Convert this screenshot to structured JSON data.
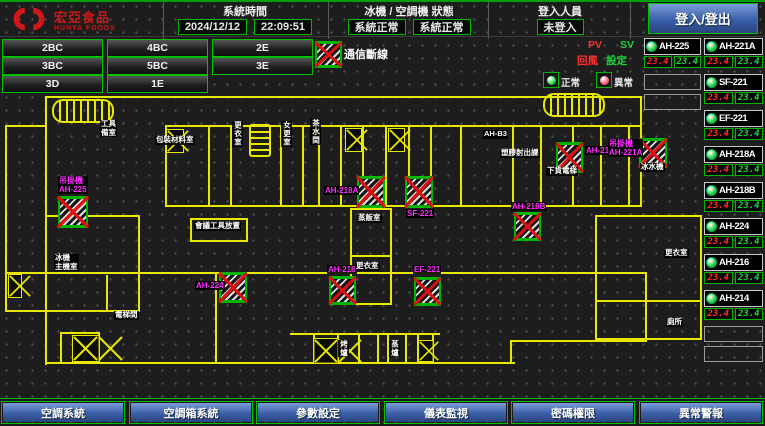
{
  "header": {
    "logo": {
      "name": "宏亞食品",
      "sub": "HUNYA FOODS"
    },
    "sections": [
      {
        "label": "系統時間",
        "values": [
          "2024/12/12",
          "22:09:51"
        ]
      },
      {
        "label": "冰機 / 空調機 狀態",
        "values": [
          "系統正常",
          "系統正常"
        ]
      },
      {
        "label": "登入人員",
        "values": [
          "未登入"
        ]
      }
    ],
    "login_button": "登入/登出"
  },
  "floor_buttons": [
    [
      "2BC",
      "4BC",
      "2E"
    ],
    [
      "3BC",
      "5BC",
      "3E"
    ],
    [
      "3D",
      "1E"
    ]
  ],
  "legend": {
    "comm_loss": "通信斷線",
    "normal": "正常",
    "abnormal": "異常",
    "pv": "PV",
    "sv": "SV",
    "pv_name": "回風",
    "sv_name": "設定"
  },
  "units": {
    "col_a": [
      {
        "name": "AH-225",
        "pv": "23.4",
        "sv": "23.4"
      }
    ],
    "col_a_empty_slots": 2,
    "col_b": [
      {
        "name": "AH-221A",
        "pv": "23.4",
        "sv": "23.4"
      },
      {
        "name": "SF-221",
        "pv": "23.4",
        "sv": "23.4"
      },
      {
        "name": "EF-221",
        "pv": "23.4",
        "sv": "23.4"
      },
      {
        "name": "AH-218A",
        "pv": "23.4",
        "sv": "23.4"
      },
      {
        "name": "AH-218B",
        "pv": "23.4",
        "sv": "23.4"
      },
      {
        "name": "AH-224",
        "pv": "23.4",
        "sv": "23.4"
      },
      {
        "name": "AH-216",
        "pv": "23.4",
        "sv": "23.4"
      },
      {
        "name": "AH-214",
        "pv": "23.4",
        "sv": "23.4"
      }
    ],
    "col_b_empty_slots": 2
  },
  "nav_buttons": [
    "空調系統",
    "空調箱系統",
    "參數設定",
    "儀表監視",
    "密碼權限",
    "異常警報"
  ],
  "map": {
    "walls": [
      [
        45,
        96,
        597,
        2
      ],
      [
        45,
        96,
        2,
        31
      ],
      [
        5,
        125,
        42,
        2
      ],
      [
        5,
        125,
        2,
        187
      ],
      [
        5,
        310,
        42,
        2
      ],
      [
        45,
        125,
        2,
        240
      ],
      [
        165,
        125,
        477,
        2
      ],
      [
        165,
        205,
        477,
        2
      ],
      [
        640,
        96,
        2,
        111
      ],
      [
        165,
        125,
        2,
        82
      ],
      [
        208,
        125,
        2,
        82
      ],
      [
        230,
        125,
        2,
        82
      ],
      [
        280,
        125,
        2,
        82
      ],
      [
        302,
        125,
        2,
        82
      ],
      [
        318,
        125,
        2,
        82
      ],
      [
        340,
        125,
        2,
        82
      ],
      [
        362,
        125,
        2,
        82
      ],
      [
        385,
        125,
        2,
        82
      ],
      [
        408,
        125,
        2,
        82
      ],
      [
        430,
        125,
        2,
        82
      ],
      [
        460,
        125,
        2,
        82
      ],
      [
        512,
        125,
        2,
        82
      ],
      [
        540,
        125,
        2,
        82
      ],
      [
        572,
        125,
        2,
        82
      ],
      [
        600,
        125,
        2,
        82
      ],
      [
        628,
        125,
        2,
        82
      ],
      [
        5,
        272,
        640,
        2
      ],
      [
        45,
        215,
        95,
        2
      ],
      [
        138,
        215,
        2,
        97
      ],
      [
        45,
        310,
        95,
        2
      ],
      [
        106,
        275,
        2,
        37
      ],
      [
        45,
        362,
        177,
        2
      ],
      [
        60,
        332,
        2,
        31
      ],
      [
        98,
        332,
        2,
        31
      ],
      [
        60,
        332,
        40,
        2
      ],
      [
        290,
        333,
        150,
        2
      ],
      [
        215,
        362,
        300,
        2
      ],
      [
        313,
        333,
        2,
        31
      ],
      [
        337,
        333,
        2,
        31
      ],
      [
        358,
        333,
        2,
        31
      ],
      [
        377,
        333,
        2,
        31
      ],
      [
        387,
        333,
        2,
        31
      ],
      [
        405,
        333,
        2,
        31
      ],
      [
        417,
        333,
        2,
        31
      ],
      [
        432,
        333,
        2,
        31
      ],
      [
        510,
        340,
        137,
        2
      ],
      [
        510,
        340,
        2,
        24
      ],
      [
        645,
        272,
        2,
        70
      ],
      [
        595,
        215,
        2,
        125
      ],
      [
        595,
        215,
        107,
        2
      ],
      [
        700,
        215,
        2,
        125
      ],
      [
        595,
        338,
        107,
        2
      ],
      [
        595,
        300,
        107,
        2
      ],
      [
        350,
        208,
        2,
        97
      ],
      [
        390,
        208,
        2,
        97
      ],
      [
        350,
        208,
        42,
        2
      ],
      [
        350,
        255,
        42,
        2
      ],
      [
        350,
        303,
        42,
        2
      ],
      [
        190,
        218,
        58,
        2
      ],
      [
        190,
        240,
        58,
        2
      ],
      [
        190,
        218,
        2,
        24
      ],
      [
        246,
        218,
        2,
        24
      ],
      [
        215,
        272,
        2,
        92
      ]
    ],
    "stairs": [
      {
        "x": 52,
        "y": 99,
        "w": 62,
        "h": 24,
        "dir": "h"
      },
      {
        "x": 543,
        "y": 93,
        "w": 62,
        "h": 24,
        "dir": "h"
      },
      {
        "x": 249,
        "y": 124,
        "w": 22,
        "h": 33,
        "dir": "v"
      }
    ],
    "fans": [
      {
        "x": 166,
        "y": 129,
        "w": 16,
        "h": 22,
        "cells": 1
      },
      {
        "x": 345,
        "y": 128,
        "w": 15,
        "h": 22,
        "cells": 1
      },
      {
        "x": 388,
        "y": 128,
        "w": 15,
        "h": 22,
        "cells": 1
      },
      {
        "x": 8,
        "y": 274,
        "w": 12,
        "h": 22,
        "cells": 1
      },
      {
        "x": 72,
        "y": 335,
        "w": 26,
        "h": 25,
        "cells": 2
      },
      {
        "x": 313,
        "y": 338,
        "w": 24,
        "h": 24,
        "cells": 2
      },
      {
        "x": 418,
        "y": 340,
        "w": 14,
        "h": 20,
        "cells": 1
      }
    ],
    "devices": [
      {
        "x": 58,
        "y": 196,
        "w": 30,
        "h": 32,
        "label": [
          "吊掛機",
          "AH-225"
        ],
        "lx": 58,
        "ly": 176
      },
      {
        "x": 357,
        "y": 176,
        "w": 28,
        "h": 32,
        "label": [
          "AH-218A"
        ],
        "lx": 324,
        "ly": 186
      },
      {
        "x": 405,
        "y": 176,
        "w": 28,
        "h": 32,
        "label": [
          "SF-221"
        ],
        "lx": 406,
        "ly": 209
      },
      {
        "x": 556,
        "y": 142,
        "w": 27,
        "h": 31,
        "label": [
          "AH-214"
        ],
        "lx": 585,
        "ly": 146
      },
      {
        "x": 639,
        "y": 138,
        "w": 28,
        "h": 30,
        "label": [
          "吊掛機",
          "AH-221A"
        ],
        "lx": 608,
        "ly": 139
      },
      {
        "x": 514,
        "y": 212,
        "w": 27,
        "h": 29,
        "label": [
          "AH-218B"
        ],
        "lx": 511,
        "ly": 202
      },
      {
        "x": 219,
        "y": 272,
        "w": 28,
        "h": 31,
        "label": [
          "AH-224"
        ],
        "lx": 195,
        "ly": 281
      },
      {
        "x": 329,
        "y": 276,
        "w": 27,
        "h": 29,
        "label": [
          "AH-216"
        ],
        "lx": 327,
        "ly": 265
      },
      {
        "x": 414,
        "y": 277,
        "w": 27,
        "h": 29,
        "label": [
          "EF-221"
        ],
        "lx": 413,
        "ly": 265
      }
    ],
    "room_labels": [
      {
        "x": 100,
        "y": 120,
        "lines": [
          "工具",
          "備室"
        ]
      },
      {
        "x": 155,
        "y": 136,
        "lines": [
          "包裝材料室"
        ]
      },
      {
        "x": 232,
        "y": 121,
        "lines": [
          "更衣室"
        ],
        "vertical": true
      },
      {
        "x": 281,
        "y": 121,
        "lines": [
          "女更室"
        ],
        "vertical": true
      },
      {
        "x": 310,
        "y": 119,
        "lines": [
          "茶水間"
        ],
        "vertical": true
      },
      {
        "x": 483,
        "y": 130,
        "lines": [
          "AH-B3"
        ]
      },
      {
        "x": 500,
        "y": 149,
        "lines": [
          "塑膠射出課"
        ]
      },
      {
        "x": 546,
        "y": 167,
        "lines": [
          "下貨電梯"
        ]
      },
      {
        "x": 640,
        "y": 163,
        "lines": [
          "冰水機"
        ]
      },
      {
        "x": 54,
        "y": 254,
        "lines": [
          "冰機",
          "主機室"
        ]
      },
      {
        "x": 114,
        "y": 311,
        "lines": [
          "電梯間"
        ]
      },
      {
        "x": 194,
        "y": 222,
        "lines": [
          "會議工具放置"
        ]
      },
      {
        "x": 357,
        "y": 214,
        "lines": [
          "蒸飯室"
        ]
      },
      {
        "x": 355,
        "y": 262,
        "lines": [
          "更衣室"
        ]
      },
      {
        "x": 664,
        "y": 249,
        "lines": [
          "更衣室"
        ]
      },
      {
        "x": 666,
        "y": 318,
        "lines": [
          "廁所"
        ]
      },
      {
        "x": 338,
        "y": 340,
        "lines": [
          "烤爐"
        ],
        "vertical": true
      },
      {
        "x": 389,
        "y": 340,
        "lines": [
          "蒸爐"
        ],
        "vertical": true
      }
    ]
  },
  "colors": {
    "accent_green": "#00b400",
    "alarm_red": "#dd1111",
    "magenta": "#ff2cff",
    "wall_yellow": "#e8e800",
    "nav_blue": "#3a5fa8"
  }
}
